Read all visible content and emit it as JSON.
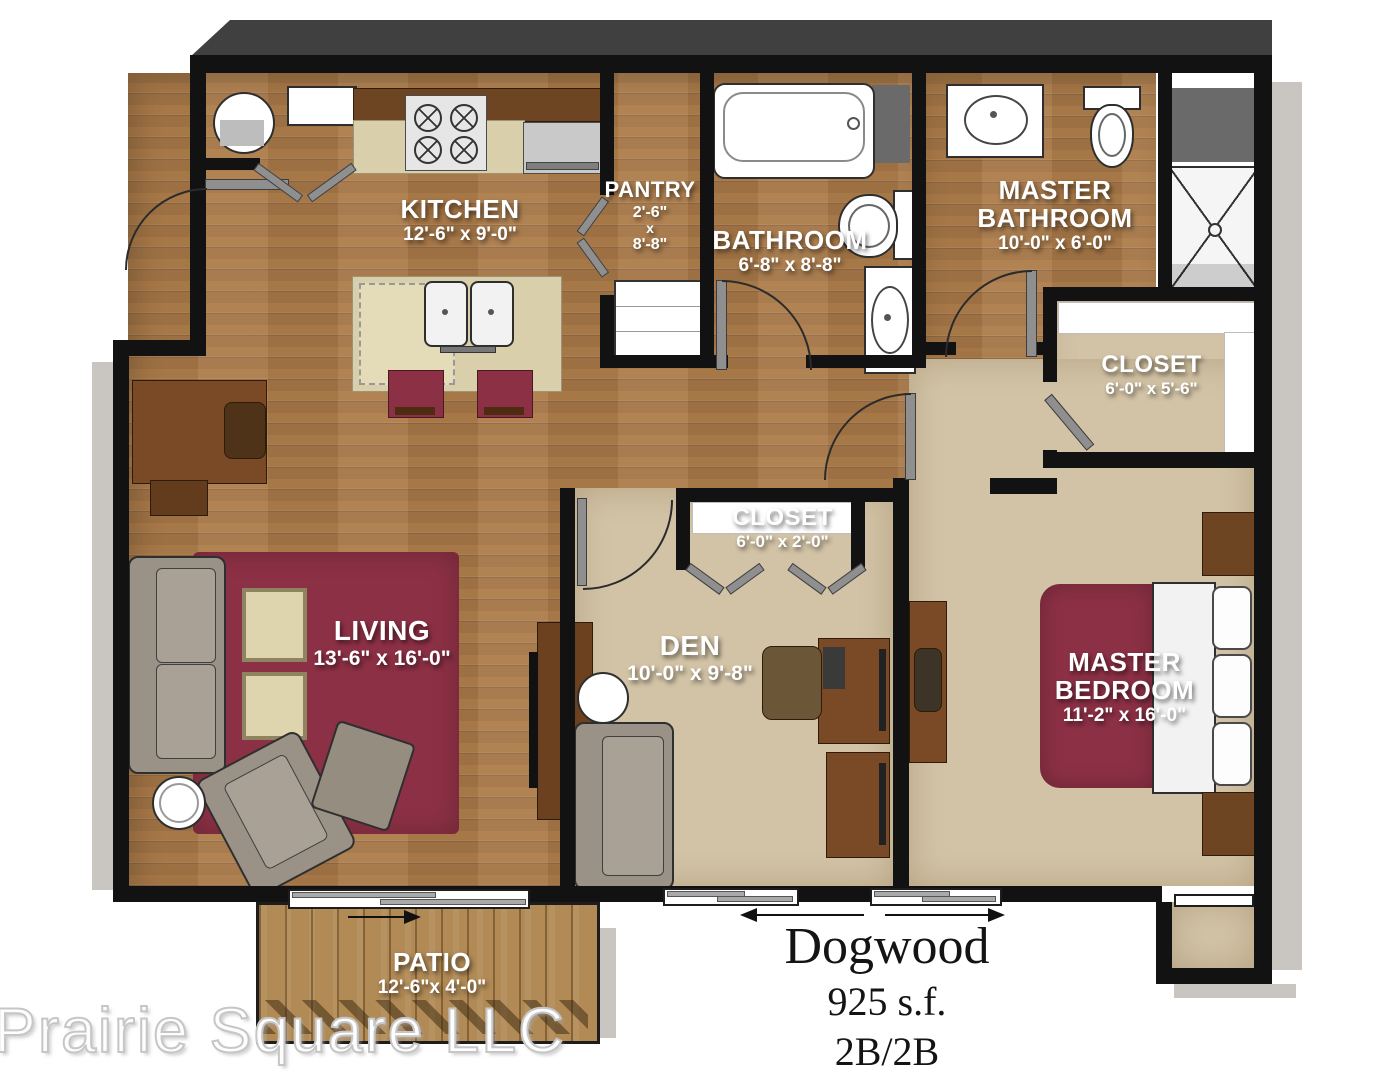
{
  "plan": {
    "title": "Dogwood",
    "area": "925 s.f.",
    "config": "2B/2B",
    "watermark": "Prairie Square LLC"
  },
  "rooms": {
    "kitchen": {
      "label": "KITCHEN",
      "dims": "12'-6\" x 9'-0\""
    },
    "pantry": {
      "label": "PANTRY",
      "dims_lines": [
        "2'-6\"",
        "x",
        "8'-8\""
      ]
    },
    "bathroom": {
      "label": "BATHROOM",
      "dims": "6'-8\" x 8'-8\""
    },
    "master_bathroom": {
      "label": "MASTER BATHROOM",
      "dims": "10'-0\" x 6'-0\""
    },
    "master_closet": {
      "label": "CLOSET",
      "dims": "6'-0\" x 5'-6\""
    },
    "den_closet": {
      "label": "CLOSET",
      "dims": "6'-0\" x 2'-0\""
    },
    "living": {
      "label": "LIVING",
      "dims": "13'-6\" x 16'-0\""
    },
    "den": {
      "label": "DEN",
      "dims": "10'-0\" x 9'-8\""
    },
    "master_bedroom": {
      "label": "MASTER BEDROOM",
      "dims": "11'-2\" x 16'-0\""
    },
    "patio": {
      "label": "PATIO",
      "dims": "12'-6\"x 4'-0\""
    }
  },
  "colors": {
    "wall": "#121212",
    "wood_floor": "#ad7c4a",
    "carpet": "#d2c3a6",
    "accent_maroon": "#8c3045",
    "deck": "#b18a55",
    "counter": "#dacfab",
    "cabinet": "#6e4523",
    "exterior_shadow": "#c9c6c2"
  }
}
